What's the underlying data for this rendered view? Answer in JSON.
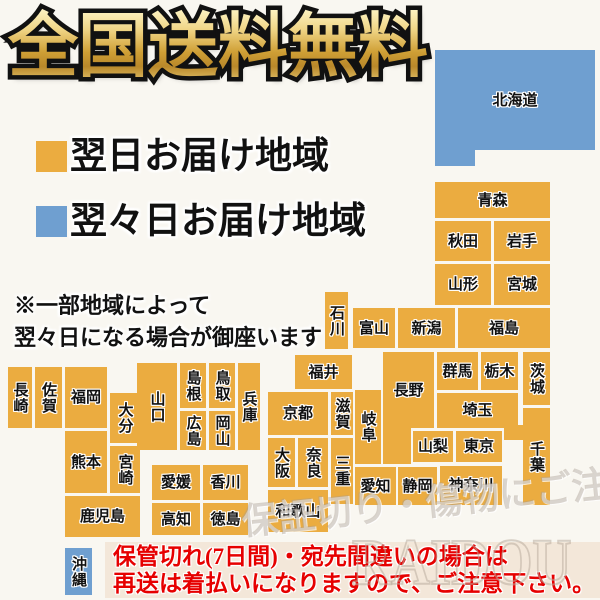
{
  "title": "全国送料無料",
  "legend": [
    {
      "label": "翌日お届け地域",
      "color": "#ebac40"
    },
    {
      "label": "翌々日お届け地域",
      "color": "#6f9fd0"
    }
  ],
  "note_lines": [
    "※一部地域によって",
    "翌々日になる場合が御座います"
  ],
  "warning": {
    "line1": "保管切れ(7日間)・宛先間違いの場合は",
    "line2": "再送は着払いになりますので、ご注意下さい。",
    "color": "#e60000",
    "bg": "#f3e7d9"
  },
  "watermarks": [
    "保証切り・傷物にご注意下さい",
    "RAIDOU"
  ],
  "colors": {
    "orange": "#ebac40",
    "blue": "#6f9fd0",
    "page_bg": "#f9f7f1"
  },
  "map": {
    "prefectures": [
      {
        "id": "hokkaido",
        "label": "北海道",
        "x": 435,
        "y": 50,
        "w": 160,
        "h": 100,
        "color": "blue",
        "vertical": false,
        "extra": [
          {
            "x": 435,
            "y": 150,
            "w": 40,
            "h": 16
          }
        ]
      },
      {
        "id": "aomori",
        "label": "青森",
        "x": 435,
        "y": 182,
        "w": 115,
        "h": 36,
        "color": "orange",
        "vertical": false
      },
      {
        "id": "akita",
        "label": "秋田",
        "x": 435,
        "y": 221,
        "w": 56,
        "h": 40,
        "color": "orange",
        "vertical": false
      },
      {
        "id": "iwate",
        "label": "岩手",
        "x": 494,
        "y": 221,
        "w": 56,
        "h": 40,
        "color": "orange",
        "vertical": false
      },
      {
        "id": "yamagata",
        "label": "山形",
        "x": 435,
        "y": 264,
        "w": 56,
        "h": 41,
        "color": "orange",
        "vertical": false
      },
      {
        "id": "miyagi",
        "label": "宮城",
        "x": 494,
        "y": 264,
        "w": 56,
        "h": 41,
        "color": "orange",
        "vertical": false
      },
      {
        "id": "fukushima",
        "label": "福島",
        "x": 458,
        "y": 308,
        "w": 92,
        "h": 40,
        "color": "orange",
        "vertical": false
      },
      {
        "id": "niigata",
        "label": "新潟",
        "x": 398,
        "y": 308,
        "w": 57,
        "h": 40,
        "color": "orange",
        "vertical": false
      },
      {
        "id": "toyama",
        "label": "富山",
        "x": 353,
        "y": 308,
        "w": 42,
        "h": 40,
        "color": "orange",
        "vertical": false
      },
      {
        "id": "ishikawa",
        "label": "石川",
        "x": 325,
        "y": 292,
        "w": 23,
        "h": 57,
        "color": "orange",
        "vertical": true
      },
      {
        "id": "fukui",
        "label": "福井",
        "x": 295,
        "y": 355,
        "w": 57,
        "h": 34,
        "color": "orange",
        "vertical": false
      },
      {
        "id": "nagano",
        "label": "長野",
        "x": 383,
        "y": 352,
        "w": 51,
        "h": 76,
        "color": "orange",
        "vertical": false,
        "extra": [
          {
            "x": 383,
            "y": 428,
            "w": 28,
            "h": 36
          }
        ]
      },
      {
        "id": "gunma",
        "label": "群馬",
        "x": 437,
        "y": 352,
        "w": 41,
        "h": 38,
        "color": "orange",
        "vertical": false
      },
      {
        "id": "tochigi",
        "label": "栃木",
        "x": 481,
        "y": 352,
        "w": 37,
        "h": 38,
        "color": "orange",
        "vertical": false
      },
      {
        "id": "ibaraki",
        "label": "茨城",
        "x": 523,
        "y": 352,
        "w": 27,
        "h": 53,
        "color": "orange",
        "vertical": true
      },
      {
        "id": "saitama",
        "label": "埼玉",
        "x": 437,
        "y": 393,
        "w": 81,
        "h": 35,
        "color": "orange",
        "vertical": false
      },
      {
        "id": "yamanashi",
        "label": "山梨",
        "x": 413,
        "y": 431,
        "w": 40,
        "h": 31,
        "color": "orange",
        "vertical": false
      },
      {
        "id": "tokyo",
        "label": "東京",
        "x": 456,
        "y": 431,
        "w": 46,
        "h": 31,
        "color": "orange",
        "vertical": false
      },
      {
        "id": "chiba",
        "label": "千葉",
        "x": 523,
        "y": 408,
        "w": 27,
        "h": 97,
        "color": "orange",
        "vertical": true,
        "extra": [
          {
            "x": 504,
            "y": 425,
            "w": 19,
            "h": 15
          }
        ]
      },
      {
        "id": "kanagawa",
        "label": "神奈川",
        "x": 440,
        "y": 466,
        "w": 62,
        "h": 39,
        "color": "orange",
        "vertical": false
      },
      {
        "id": "shizuoka",
        "label": "静岡",
        "x": 398,
        "y": 467,
        "w": 39,
        "h": 38,
        "color": "orange",
        "vertical": false
      },
      {
        "id": "aichi",
        "label": "愛知",
        "x": 355,
        "y": 467,
        "w": 41,
        "h": 38,
        "color": "orange",
        "vertical": false
      },
      {
        "id": "gifu",
        "label": "岐阜",
        "x": 355,
        "y": 390,
        "w": 26,
        "h": 74,
        "color": "orange",
        "vertical": true
      },
      {
        "id": "shiga",
        "label": "滋賀",
        "x": 331,
        "y": 392,
        "w": 22,
        "h": 43,
        "color": "orange",
        "vertical": true
      },
      {
        "id": "mie",
        "label": "三重",
        "x": 331,
        "y": 438,
        "w": 22,
        "h": 66,
        "color": "orange",
        "vertical": true
      },
      {
        "id": "kyoto",
        "label": "京都",
        "x": 268,
        "y": 392,
        "w": 60,
        "h": 43,
        "color": "orange",
        "vertical": false
      },
      {
        "id": "osaka",
        "label": "大阪",
        "x": 268,
        "y": 438,
        "w": 27,
        "h": 49,
        "color": "orange",
        "vertical": true
      },
      {
        "id": "nara",
        "label": "奈良",
        "x": 298,
        "y": 438,
        "w": 30,
        "h": 49,
        "color": "orange",
        "vertical": true
      },
      {
        "id": "wakayama",
        "label": "和歌山",
        "x": 268,
        "y": 490,
        "w": 60,
        "h": 42,
        "color": "orange",
        "vertical": false
      },
      {
        "id": "hyogo",
        "label": "兵庫",
        "x": 238,
        "y": 363,
        "w": 22,
        "h": 87,
        "color": "orange",
        "vertical": true
      },
      {
        "id": "tottori",
        "label": "鳥取",
        "x": 209,
        "y": 363,
        "w": 26,
        "h": 45,
        "color": "orange",
        "vertical": true
      },
      {
        "id": "shimane",
        "label": "島根",
        "x": 180,
        "y": 363,
        "w": 26,
        "h": 45,
        "color": "orange",
        "vertical": true
      },
      {
        "id": "okayama",
        "label": "岡山",
        "x": 209,
        "y": 411,
        "w": 26,
        "h": 39,
        "color": "orange",
        "vertical": true
      },
      {
        "id": "hiroshima",
        "label": "広島",
        "x": 180,
        "y": 411,
        "w": 26,
        "h": 39,
        "color": "orange",
        "vertical": true
      },
      {
        "id": "yamaguchi",
        "label": "山口",
        "x": 137,
        "y": 363,
        "w": 40,
        "h": 87,
        "color": "orange",
        "vertical": true
      },
      {
        "id": "kagawa",
        "label": "香川",
        "x": 203,
        "y": 465,
        "w": 45,
        "h": 35,
        "color": "orange",
        "vertical": false
      },
      {
        "id": "ehime",
        "label": "愛媛",
        "x": 152,
        "y": 465,
        "w": 48,
        "h": 35,
        "color": "orange",
        "vertical": false
      },
      {
        "id": "tokushima",
        "label": "徳島",
        "x": 203,
        "y": 503,
        "w": 45,
        "h": 32,
        "color": "orange",
        "vertical": false
      },
      {
        "id": "kochi",
        "label": "高知",
        "x": 152,
        "y": 503,
        "w": 48,
        "h": 32,
        "color": "orange",
        "vertical": false
      },
      {
        "id": "fukuoka",
        "label": "福岡",
        "x": 65,
        "y": 367,
        "w": 42,
        "h": 61,
        "color": "orange",
        "vertical": false
      },
      {
        "id": "saga",
        "label": "佐賀",
        "x": 35,
        "y": 367,
        "w": 27,
        "h": 61,
        "color": "orange",
        "vertical": true
      },
      {
        "id": "nagasaki",
        "label": "長崎",
        "x": 8,
        "y": 367,
        "w": 24,
        "h": 61,
        "color": "orange",
        "vertical": true
      },
      {
        "id": "oita",
        "label": "大分",
        "x": 110,
        "y": 393,
        "w": 30,
        "h": 50,
        "color": "orange",
        "vertical": true
      },
      {
        "id": "kumamoto",
        "label": "熊本",
        "x": 65,
        "y": 431,
        "w": 42,
        "h": 62,
        "color": "orange",
        "vertical": false
      },
      {
        "id": "miyazaki",
        "label": "宮崎",
        "x": 110,
        "y": 446,
        "w": 30,
        "h": 47,
        "color": "orange",
        "vertical": true
      },
      {
        "id": "kagoshima",
        "label": "鹿児島",
        "x": 65,
        "y": 496,
        "w": 75,
        "h": 41,
        "color": "orange",
        "vertical": false
      },
      {
        "id": "okinawa",
        "label": "沖縄",
        "x": 65,
        "y": 548,
        "w": 27,
        "h": 47,
        "color": "blue",
        "vertical": true
      }
    ]
  }
}
